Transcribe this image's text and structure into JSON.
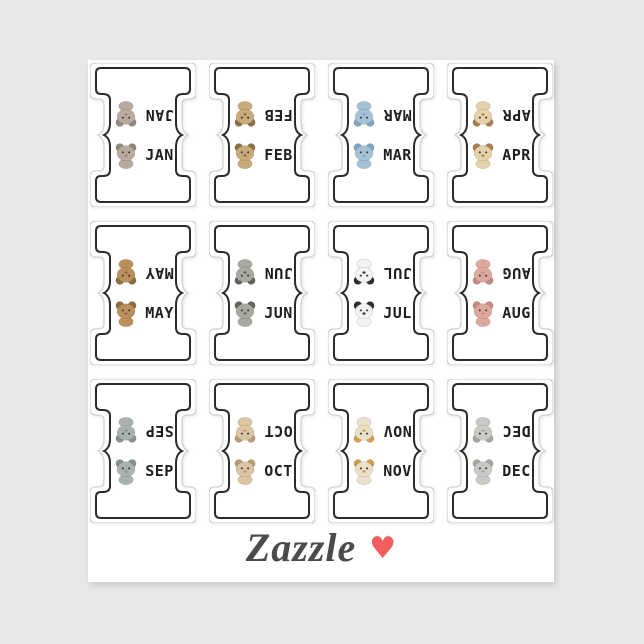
{
  "page": {
    "background_color": "#e8e8e8",
    "sheet_color": "#ffffff"
  },
  "branding": {
    "logo_text": "Zazzle",
    "logo_color": "#4b4b4b",
    "heart_glyph": "♥",
    "heart_color": "#f15e5e"
  },
  "sticker_sheet": {
    "outline_color": "#2b2b2b",
    "diecut_edge_color": "#d3d3d3",
    "tabs": [
      {
        "month": "JAN",
        "animal": "koala",
        "colors": {
          "main": "#b9ab9c",
          "accent": "#93887a"
        }
      },
      {
        "month": "FEB",
        "animal": "owl",
        "colors": {
          "main": "#c9aa79",
          "accent": "#8d6f49"
        }
      },
      {
        "month": "MAR",
        "animal": "whale",
        "colors": {
          "main": "#a3c2d8",
          "accent": "#7fa6c0"
        }
      },
      {
        "month": "APR",
        "animal": "snail",
        "colors": {
          "main": "#e6d2a8",
          "accent": "#a97f52"
        }
      },
      {
        "month": "MAY",
        "animal": "sloth",
        "colors": {
          "main": "#bb905a",
          "accent": "#8f6b3e"
        }
      },
      {
        "month": "JUN",
        "animal": "raccoon",
        "colors": {
          "main": "#a9a9a1",
          "accent": "#62625a"
        }
      },
      {
        "month": "JUL",
        "animal": "panda",
        "colors": {
          "main": "#f2f2f0",
          "accent": "#2e2e2e"
        }
      },
      {
        "month": "AUG",
        "animal": "octopus",
        "colors": {
          "main": "#dfa89e",
          "accent": "#c68a82"
        }
      },
      {
        "month": "SEP",
        "animal": "hippo",
        "colors": {
          "main": "#a9b2ad",
          "accent": "#87928c"
        }
      },
      {
        "month": "OCT",
        "animal": "bunny",
        "colors": {
          "main": "#dbc5a2",
          "accent": "#b79c70"
        }
      },
      {
        "month": "NOV",
        "animal": "goose",
        "colors": {
          "main": "#eae0ca",
          "accent": "#d59d4e"
        }
      },
      {
        "month": "DEC",
        "animal": "elephant",
        "colors": {
          "main": "#c9cac4",
          "accent": "#a5a6a0"
        }
      }
    ]
  }
}
